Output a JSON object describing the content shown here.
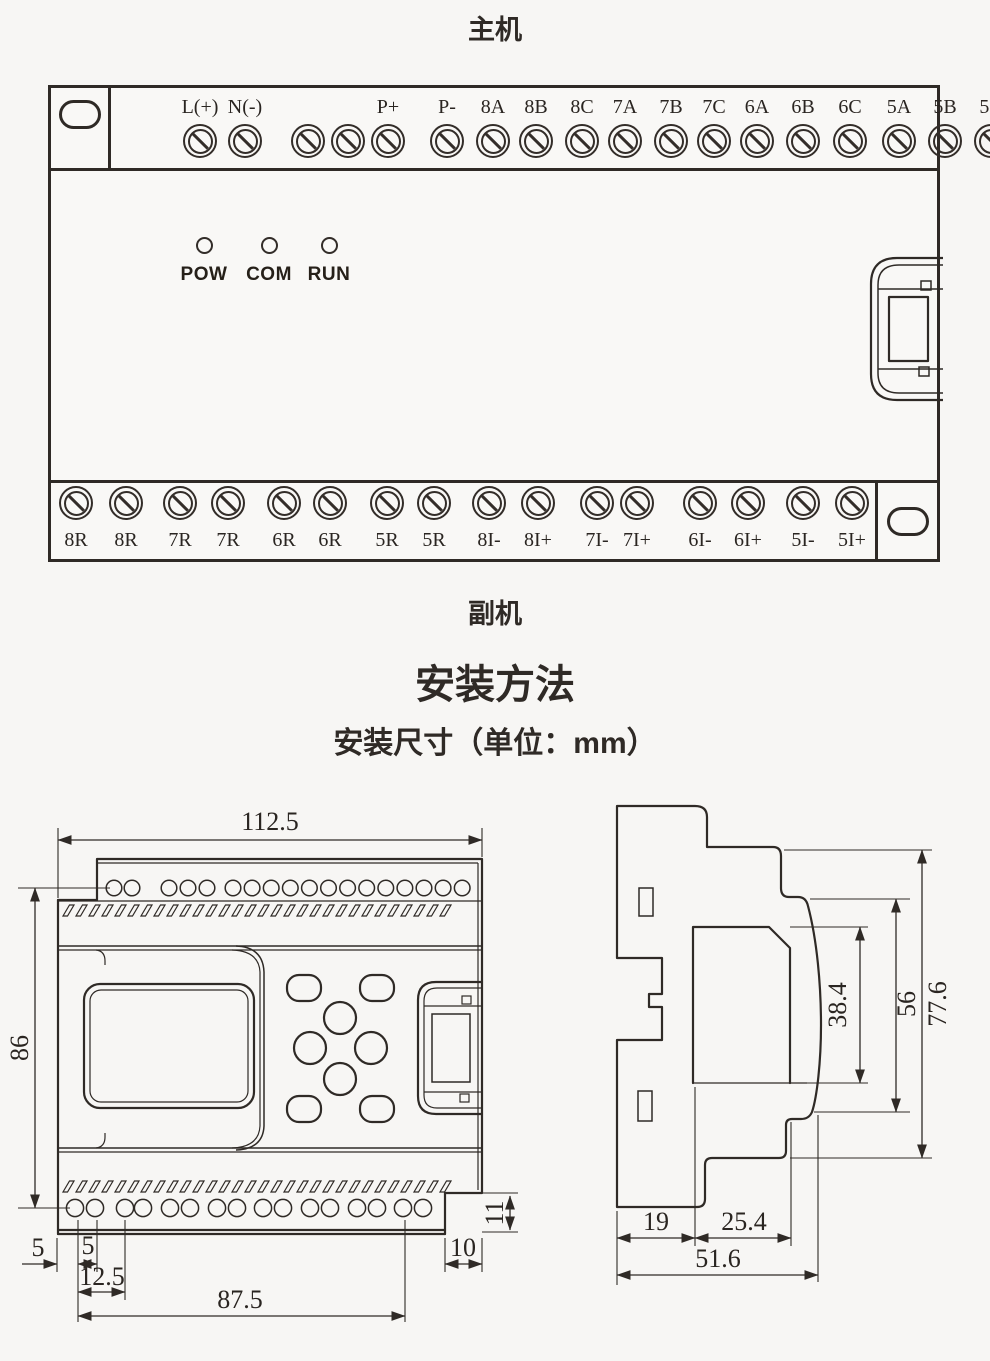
{
  "titles": {
    "main_unit": "主机",
    "secondary_unit": "副机",
    "install_heading": "安装方法",
    "install_sub": "安装尺寸（单位：mm）"
  },
  "main_unit": {
    "top_terminals": [
      "L(+)",
      "N(-)",
      "",
      "",
      "P+",
      "P-",
      "8A",
      "8B",
      "8C",
      "7A",
      "7B",
      "7C",
      "6A",
      "6B",
      "6C",
      "5A",
      "5B",
      "5C"
    ],
    "leds": [
      "POW",
      "COM",
      "RUN"
    ],
    "bottom_terminals": [
      "8R",
      "8R",
      "7R",
      "7R",
      "6R",
      "6R",
      "5R",
      "5R",
      "8I-",
      "8I+",
      "7I-",
      "7I+",
      "6I-",
      "6I+",
      "5I-",
      "5I+"
    ]
  },
  "front_view": {
    "width": "112.5",
    "height": "86",
    "offset_left": "5",
    "pitch": "5",
    "offset_pair": "12.5",
    "span": "87.5",
    "notch_width": "10",
    "notch_height": "11"
  },
  "side_view": {
    "depth_front": "19",
    "depth_mid": "25.4",
    "depth_total": "51.6",
    "h_inner": "38.4",
    "h_mid": "56",
    "h_total": "77.6"
  },
  "colors": {
    "line": "#2f2a26",
    "background": "#f7f6f4"
  }
}
